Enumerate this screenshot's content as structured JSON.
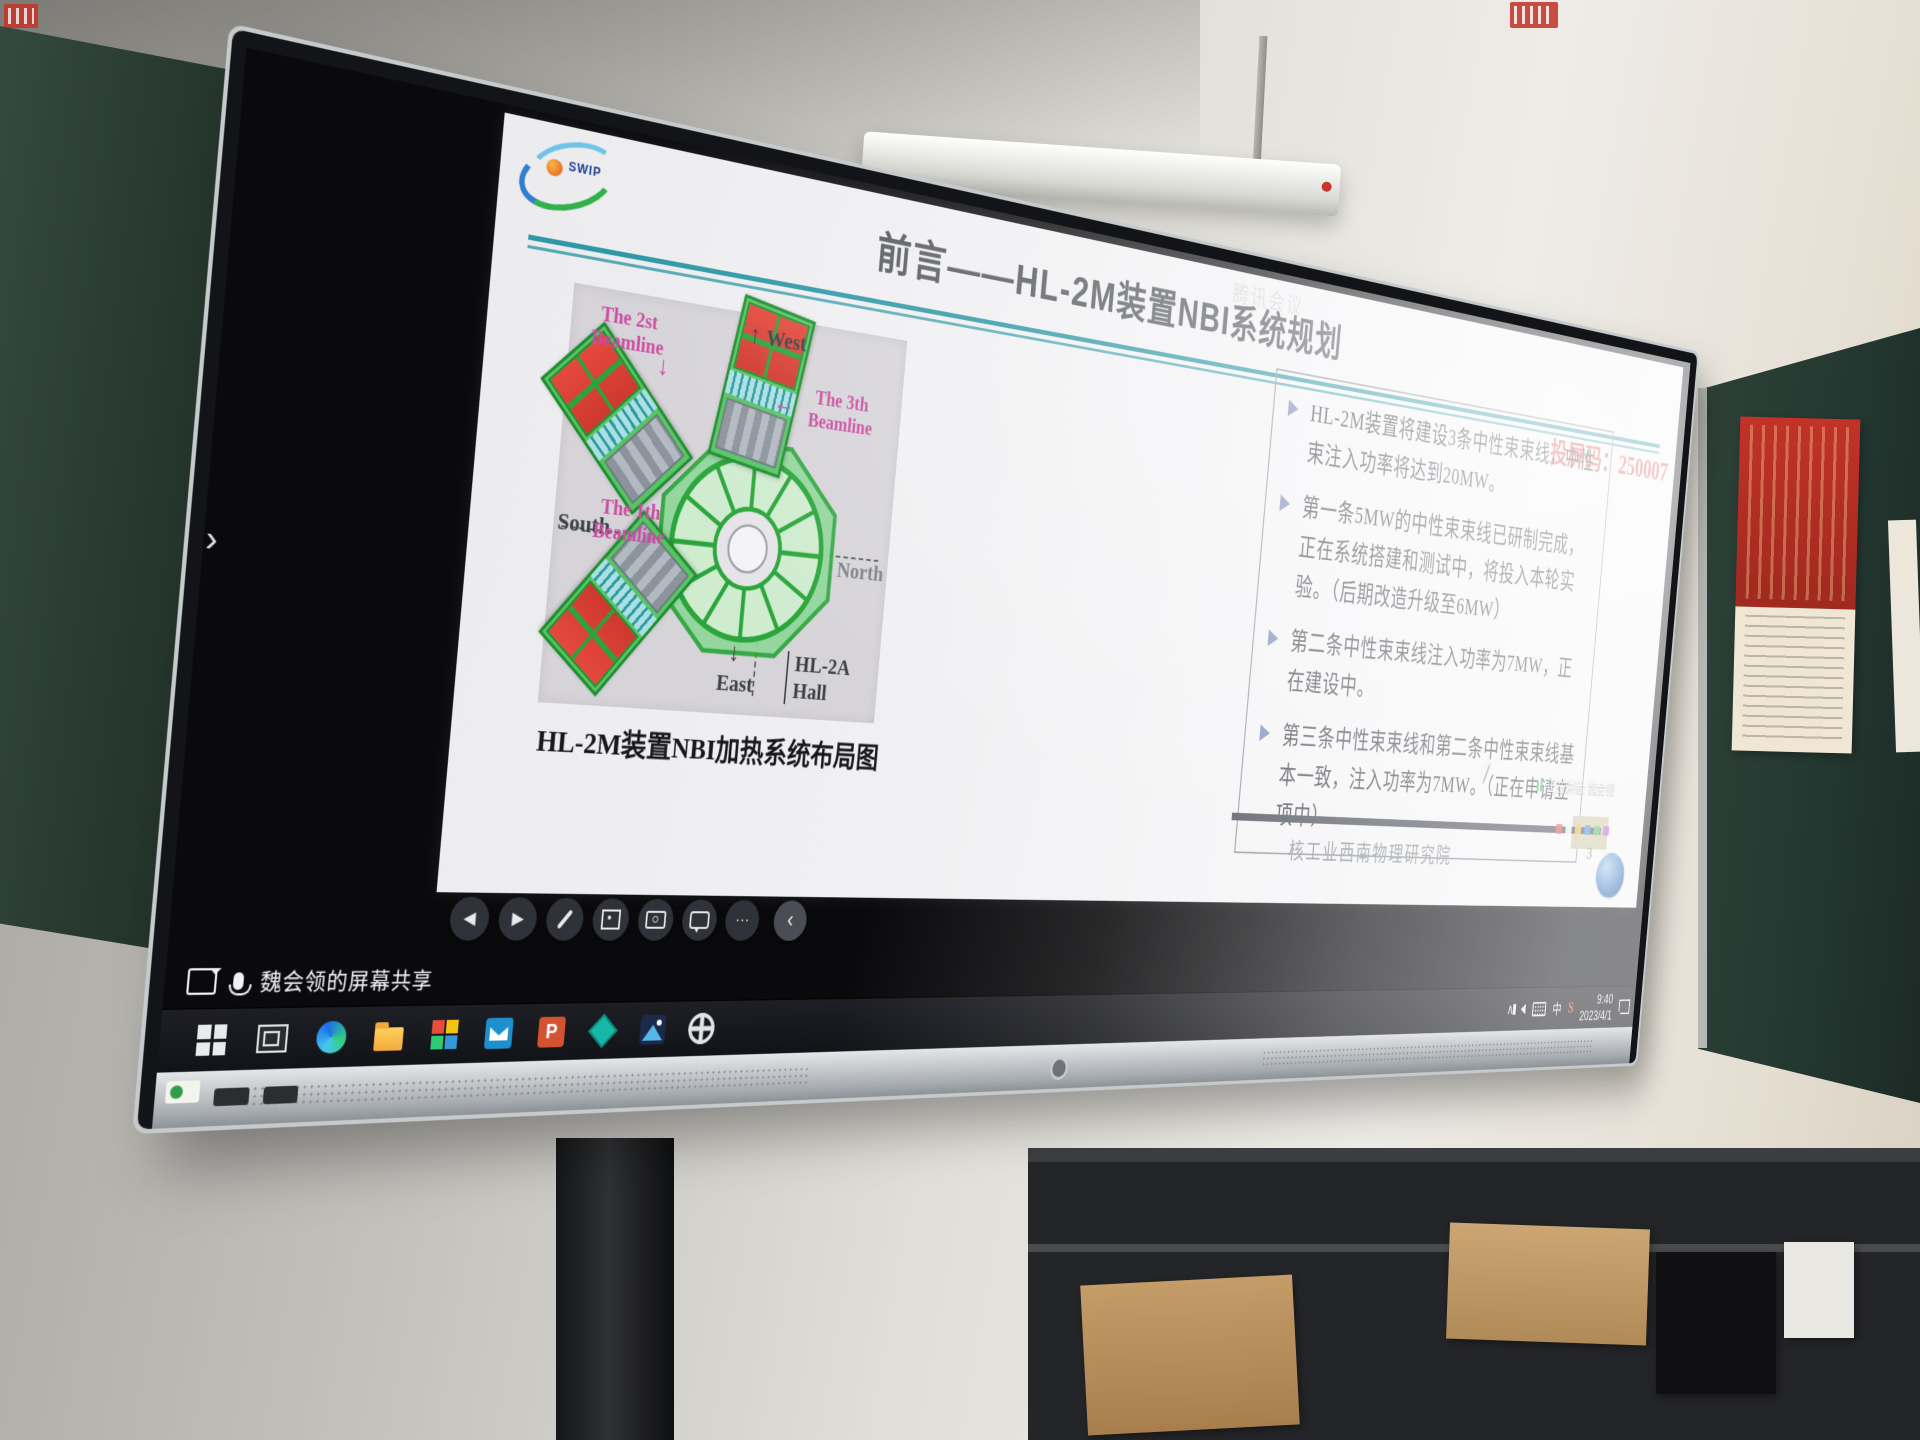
{
  "overlay": {
    "cast_code": "投屏码：250007",
    "meeting_watermark": "腾讯会议",
    "speaking": "正在讲话: 魏会领"
  },
  "slide": {
    "logo_text": "SWIP",
    "title": "前言——HL-2M装置NBI系统规划",
    "diagram": {
      "caption": "HL-2M装置NBI加热系统布局图",
      "beamline_2_label": "The 2st Beamline",
      "beamline_3_label": "The 3th Beamline",
      "beamline_1_label": "The 1th Beamline",
      "compass_west": "West",
      "compass_north": "North",
      "compass_south": "South",
      "compass_east": "East",
      "hall_label": "HL-2A Hall",
      "arrow_up": "↑",
      "arrow_down": "↓",
      "arrow_left": "←",
      "machine_green": "#35b44a",
      "panel_red": "#e5493d",
      "label_pink": "#cb4ba2"
    },
    "bullets": [
      "HL-2M装置将建设3条中性束束线，中性束注入功率将达到20MW。",
      "第一条5MW的中性束束线已研制完成，正在系统搭建和测试中，将投入本轮实验。（后期改造升级至6MW）",
      "第二条中性束束线注入功率为7MW，正在建设中。",
      "第三条中性束束线和第二条中性束束线基本一致，注入功率为7MW。（正在申请立项中）"
    ],
    "footer_org": "核工业西南物理研究院",
    "page_number": "3",
    "accent_teal": "#2e98a6",
    "cast_red": "#dd5f58"
  },
  "presenter_toolbar": {
    "button_icons": [
      "previous-icon",
      "next-icon",
      "pen-icon",
      "screenshot-icon",
      "camera-icon",
      "comment-icon",
      "more-icon",
      "collapse-icon"
    ],
    "prev_glyph": "◀",
    "next_glyph": "▶",
    "more_glyph": "···",
    "collapse_glyph": "‹"
  },
  "screen": {
    "edge_chevron_glyph": "›"
  },
  "taskbar": {
    "share_label": "魏会领的屏幕共享",
    "app_icons": [
      "windows-start-icon",
      "task-view-icon",
      "edge-browser-icon",
      "file-explorer-icon",
      "whiteboard-grid-icon",
      "mail-icon",
      "powerpoint-icon",
      "seewo-diamond-icon",
      "easinote-icon",
      "settings-gear-icon"
    ],
    "ppt_letter": "P",
    "tray": {
      "icon_names": [
        "expand-chevron-icon",
        "speaker-icon",
        "keyboard-icon",
        "language-indicator",
        "brand-s-icon",
        "clock",
        "notification-icon"
      ],
      "expand_glyph": "∧",
      "language": "中",
      "brand_letter": "S",
      "time": "9:40",
      "date": "2023/4/1"
    }
  }
}
